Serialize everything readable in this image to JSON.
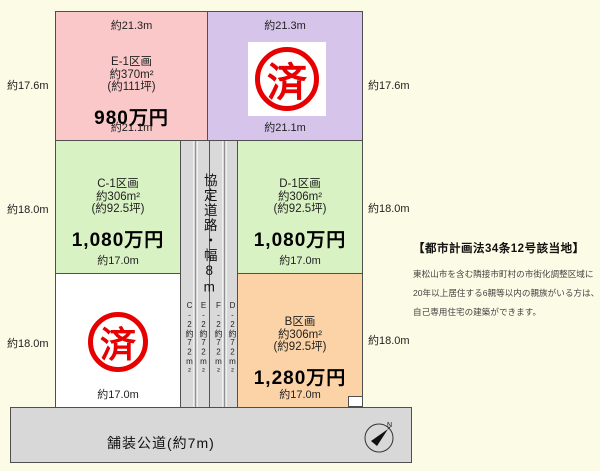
{
  "colors": {
    "background": "#fcfbe5",
    "plot_e1": "#fac8c8",
    "plot_a": "#d6c4ea",
    "plot_c1": "#d9f2c3",
    "plot_d1": "#d9f2c3",
    "plot_b": "#fbd3a6",
    "plot_sold_lower": "#ffffff",
    "road": "#d9d9d9",
    "stamp_red": "#e60000",
    "border": "#4f4f4f"
  },
  "plots": {
    "e1": {
      "name": "E-1区画",
      "area": "約370m²",
      "tsubo": "(約111坪)",
      "price": "980万円",
      "dim_top": "約21.3m",
      "dim_bottom": "約21.1m",
      "dim_left": "約17.6m"
    },
    "a": {
      "stamp": "済",
      "dim_top": "約21.3m",
      "dim_bottom": "約21.1m",
      "dim_right": "約17.6m"
    },
    "c1": {
      "name": "C-1区画",
      "area": "約306m²",
      "tsubo": "(約92.5坪)",
      "price": "1,080万円",
      "dim_bottom": "約17.0m",
      "dim_left": "約18.0m"
    },
    "d1": {
      "name": "D-1区画",
      "area": "約306m²",
      "tsubo": "(約92.5坪)",
      "price": "1,080万円",
      "dim_bottom": "約17.0m",
      "dim_right": "約18.0m"
    },
    "sold_lower": {
      "stamp": "済",
      "dim_bottom": "約17.0m",
      "dim_left": "約18.0m"
    },
    "b": {
      "name": "B区画",
      "area": "約306m²",
      "tsubo": "(約92.5坪)",
      "price": "1,280万円",
      "dim_bottom": "約17.0m",
      "dim_right": "約18.0m"
    }
  },
  "agreement_road": {
    "label": "協定道路・幅8m",
    "lanes": [
      {
        "label": "C-2約72m²",
        "width": "2m"
      },
      {
        "label": "E-2約72m²",
        "width": "2m"
      },
      {
        "label": "F-2約72m²",
        "width": "2m"
      },
      {
        "label": "D-2約72m²",
        "width": "2m"
      }
    ]
  },
  "public_road": {
    "label": "舗装公道(約7m)",
    "compass_north": "N"
  },
  "notice": {
    "heading": "【都市計画法34条12号該当地】",
    "lines": [
      "東松山市を含む隣接市町村の市街化調整区域に",
      "20年以上居住する6親等以内の親族がいる方は、",
      "自己専用住宅の建築ができます。"
    ]
  }
}
